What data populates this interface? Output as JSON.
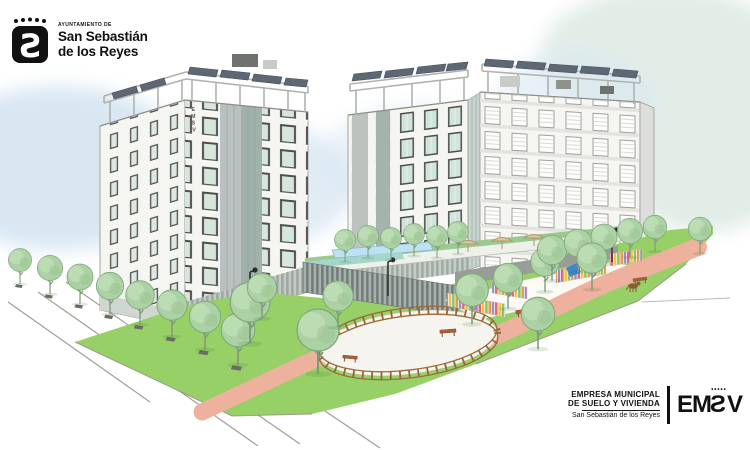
{
  "header_logo": {
    "org_type": "AYUNTAMIENTO DE",
    "name_line1": "San Sebastián",
    "name_line2": "de los Reyes",
    "emblem_icon": "crown-dots-shield-s"
  },
  "building_sign": {
    "letters": [
      "E",
      "M",
      "S",
      "V"
    ]
  },
  "footer_logo": {
    "company_line1": "EMPRESA MUNICIPAL",
    "company_line2": "DE SUELO Y VIVIENDA",
    "subtitle": "San Sebastián de los Reyes",
    "mark_prefix": "EM",
    "mark_middle": "S",
    "mark_suffix": "V",
    "mark_crown_dots": "•••••"
  },
  "colors": {
    "sky_blue": "#d9e7f3",
    "sky_green": "#e2ede7",
    "lawn_green": "#97d066",
    "path_pink": "#eeb19e",
    "tree_green": "#abd1a4",
    "wood_brown": "#95663a",
    "pool_blue": "#bfe2f2",
    "facade_white": "#f5f5f2",
    "solar_dark": "#5d6874",
    "logo_black": "#111111"
  }
}
